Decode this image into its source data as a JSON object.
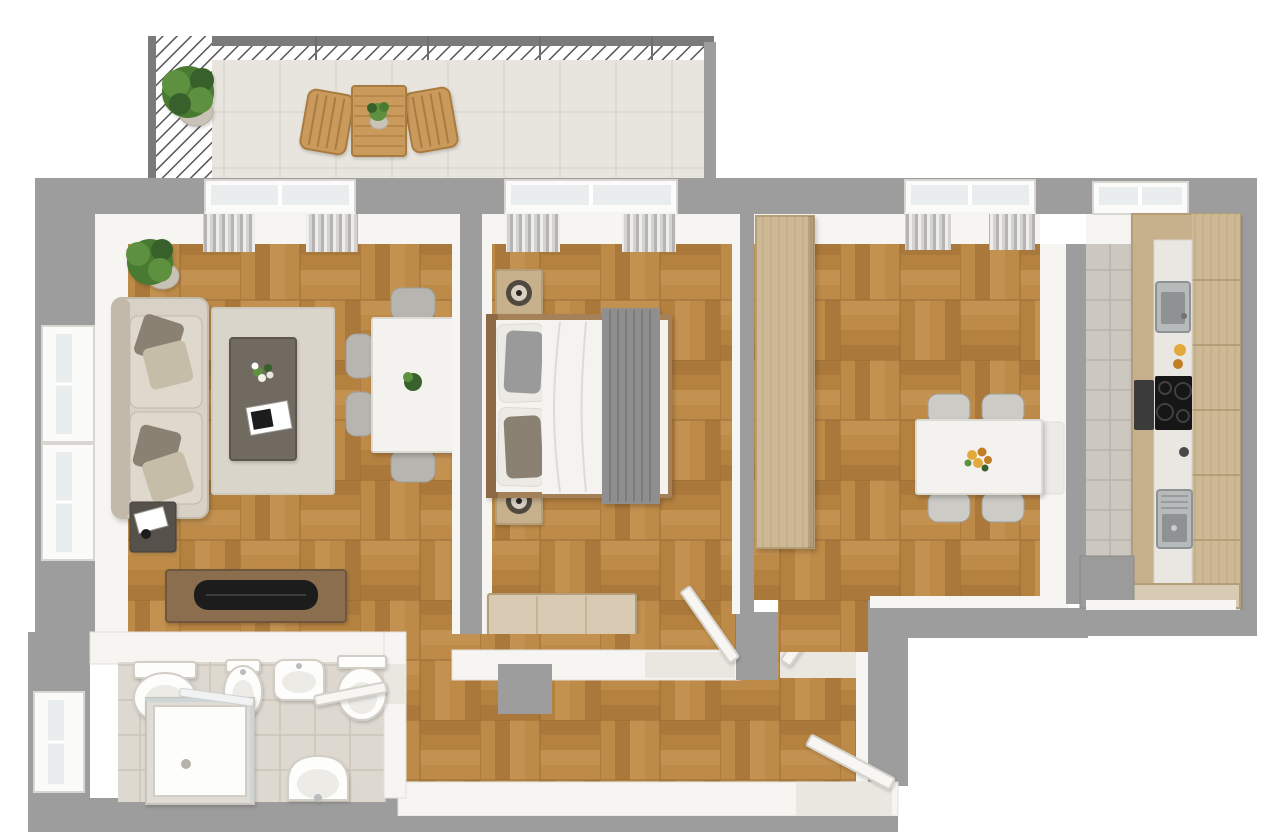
{
  "scene": {
    "title": "3D top-down floor plan of a two-room apartment with terrace",
    "view": "top-down 3D architectural render",
    "background_color": "#ffffff"
  },
  "palette": {
    "bg": "#ffffff",
    "wall": "#9d9d9d",
    "wall_dark": "#7a7a7a",
    "wall_face": "#f6f5f2",
    "face_line": "#e2e0da",
    "wood1": "#b5813f",
    "wood2": "#bd8a47",
    "wood3": "#aa783a",
    "wood4": "#c39150",
    "wood_line": "#8f6630",
    "terrace_tile": "#e8e5de",
    "terrace_tile_line": "#dcd8d0",
    "bath_tile": "#ded9d0",
    "bath_tile_line": "#cbc5b9",
    "kitchen_tile": "#ccc7bf",
    "kitchen_tile_line": "#bab4ab",
    "white_furniture": "#f3f2ee",
    "white_line": "#dcdad4",
    "chair": "#b7b5b0",
    "chair_light": "#cccbc6",
    "chair_line": "#a09e99",
    "sofa": "#d8d1c6",
    "sofa_dark": "#c2b9ab",
    "cushion": "#dfd8cd",
    "pillow_dark": "#8b8172",
    "pillow_light": "#c6bda9",
    "pillow_gray": "#9a9a9a",
    "rug": "#dad5cb",
    "rug_line": "#cfc9bd",
    "coffee_table": "#716b60",
    "coffee_table_line": "#5c574e",
    "wood_light": "#c7b08c",
    "wood_light_line": "#b49e78",
    "chest": "#d8cab3",
    "wood_mid": "#a5815a",
    "wood_dark": "#8a6e4d",
    "wood_dark_line": "#6f573c",
    "wardrobe": "#cdb995",
    "wardrobe_line": "#bfa77d",
    "outdoor_wood": "#c99a5b",
    "outdoor_wood_line": "#a87c40",
    "tv": "#1d1d1d",
    "door": "#f7f6f3",
    "door_line": "#d5d2cb",
    "threshold": "#eae7e1",
    "fixture": "#fdfdfc",
    "fixture_line": "#d2cec6",
    "fixture_inner": "#ecebe6",
    "steel": "#b7babb",
    "steel_dark": "#8f9293",
    "cooktop": "#141414",
    "blanket": "#8f8f8f",
    "blanket_line": "#787878",
    "duvet": "#f4f3f0",
    "sheet_line": "#dddbd5",
    "green1": "#4a7a33",
    "green2": "#5d9140",
    "green3": "#39612b",
    "pot": "#c9c3b7",
    "pot_line": "#b4ad9f",
    "glass": "#e9edee",
    "frame": "#fbfbfa",
    "frame_line": "#d9d6d1",
    "radiator": "#eceae6",
    "appliance": "#9b9b9b",
    "flower_yellow": "#e3a93c",
    "flower_orange": "#c27e22",
    "lamp_dark": "#4f4840",
    "lamp_light": "#d8d1c3",
    "curtain1": "#ededec",
    "curtain2": "#d4d3d1",
    "curtain3": "#b5b4b2",
    "railing_line": "#565656"
  },
  "rooms": [
    {
      "id": "terrace",
      "name": "Terrace",
      "floor": "light ceramic tile",
      "items": [
        "hatched safety railing",
        "potted plant",
        "wooden bistro table",
        "small table plant"
      ],
      "chair_count": 2
    },
    {
      "id": "living-room",
      "name": "Living room",
      "floor": "oak basket-weave parquet",
      "items": [
        "fabric sofa with four pillows",
        "corner potted plant",
        "dark side table with magazine",
        "area rug",
        "dark coffee table with flowers and magazine",
        "white dining table",
        "tv sideboard with flat tv",
        "two left-wall windows",
        "curtained front window"
      ],
      "chair_count": 6
    },
    {
      "id": "bedroom",
      "name": "Bedroom",
      "floor": "oak basket-weave parquet",
      "items": [
        "double bed with white duvet and gray throw",
        "two nightstands with lamps",
        "storage bench",
        "curtained window",
        "open door"
      ],
      "pillow_count": 4
    },
    {
      "id": "dining-room",
      "name": "Dining room",
      "floor": "oak basket-weave parquet",
      "items": [
        "tall wooden wardrobe",
        "white square dining table",
        "flower centerpiece",
        "radiator",
        "curtained window",
        "open door"
      ],
      "chair_count": 4
    },
    {
      "id": "kitchen",
      "name": "Kitchen",
      "floor": "gray stone tile",
      "items": [
        "galley counter with wooden cabinets",
        "two steel sinks",
        "black cooktop",
        "oven",
        "free-standing appliance",
        "window"
      ]
    },
    {
      "id": "bathroom",
      "name": "Bathroom",
      "floor": "beige ceramic tile",
      "items": [
        "toilet",
        "bidet",
        "washbasin",
        "wall-hung toilet",
        "corner shower cabin",
        "pedestal sink",
        "side window",
        "open door"
      ]
    },
    {
      "id": "hallway",
      "name": "Hallway",
      "floor": "oak basket-weave parquet",
      "items": [
        "entry door ajar",
        "door thresholds",
        "wall pillar"
      ]
    }
  ]
}
